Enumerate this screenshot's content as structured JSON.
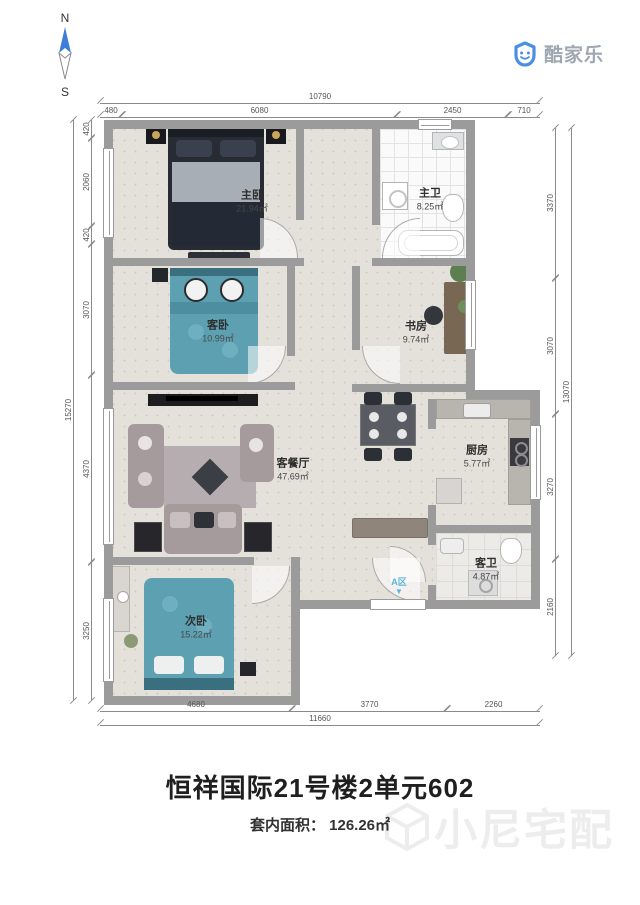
{
  "compass": {
    "north": "N",
    "south": "S"
  },
  "logo": {
    "text": "酷家乐"
  },
  "watermark": {
    "text": "小尼宅配"
  },
  "entry": {
    "label": "A区",
    "arrow": "▼"
  },
  "title": {
    "name": "恒祥国际21号楼2单元602",
    "area_label": "套内面积： ",
    "area_value": "126.26㎡"
  },
  "rooms": {
    "master_bedroom": {
      "name": "主卧",
      "area": "21.94㎡"
    },
    "master_bath": {
      "name": "主卫",
      "area": "8.25㎡"
    },
    "guest_bedroom": {
      "name": "客卧",
      "area": "10.99㎡"
    },
    "study": {
      "name": "书房",
      "area": "9.74㎡"
    },
    "living_dining": {
      "name": "客餐厅",
      "area": "47.69㎡"
    },
    "kitchen": {
      "name": "厨房",
      "area": "5.77㎡"
    },
    "guest_bath": {
      "name": "客卫",
      "area": "4.87㎡"
    },
    "second_bedroom": {
      "name": "次卧",
      "area": "15.22㎡"
    }
  },
  "dims": {
    "top": {
      "total": "10790",
      "segments": [
        "480",
        "6080",
        "2450",
        "710"
      ]
    },
    "bottom": {
      "total": "11660",
      "segments": [
        "4680",
        "3770",
        "2260"
      ]
    },
    "left": {
      "total": "15270",
      "segments": [
        "420",
        "2060",
        "420",
        "3070",
        "4370",
        "3250"
      ]
    },
    "right": {
      "total": "13070",
      "segments": [
        "3370",
        "3070",
        "3270",
        "2160"
      ]
    }
  },
  "colors": {
    "wall": "#9b9b9b",
    "floor": "#e4e1db",
    "bed_teal": "#5ca0b2",
    "bed_dark": "#242a35",
    "sofa": "#a59a9c",
    "accent_blue": "#4a8fe2",
    "entry_label": "#5bb6d9",
    "watermark": "#ededed"
  }
}
